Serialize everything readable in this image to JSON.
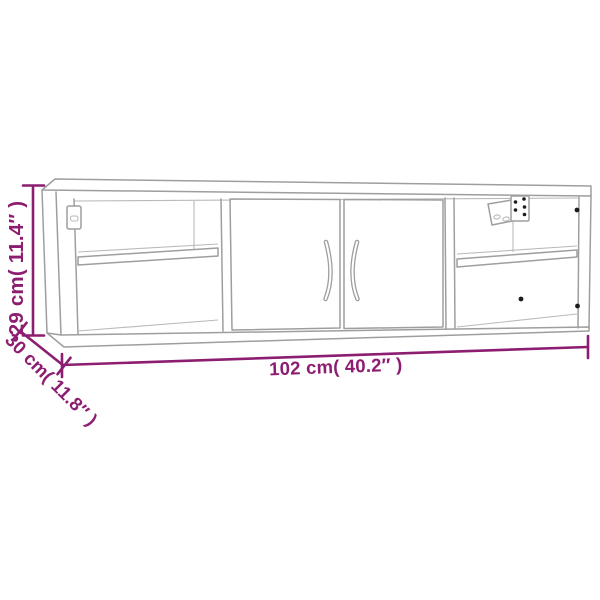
{
  "page": {
    "background": "#ffffff"
  },
  "drawing": {
    "kind": "product-dimension-line-drawing",
    "subject": "wall-mounted cabinet with two center doors and open side compartments with shelves",
    "colors": {
      "background": "#ffffff",
      "furniture_line": "#9e9e9e",
      "furniture_line_light": "#bababa",
      "dimension": "#8c1d70",
      "hardware_dot": "#1c1c1c"
    },
    "dimensions": {
      "height_label": "29 cm( 11.4″ )",
      "depth_label": "30 cm( 11.8″ )",
      "width_label": "102 cm( 40.2″ )"
    }
  }
}
